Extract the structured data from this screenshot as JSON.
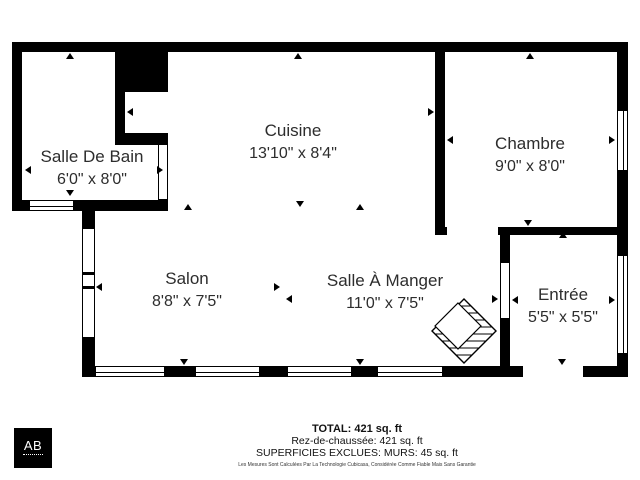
{
  "colors": {
    "wall": "#000000",
    "text": "#2d2d2d",
    "background": "#ffffff"
  },
  "rooms": [
    {
      "name": "Salle De Bain",
      "dims": "6'0\" x 8'0\""
    },
    {
      "name": "Cuisine",
      "dims": "13'10\" x 8'4\""
    },
    {
      "name": "Chambre",
      "dims": "9'0\" x 8'0\""
    },
    {
      "name": "Salon",
      "dims": "8'8\" x 7'5\""
    },
    {
      "name": "Salle À Manger",
      "dims": "11'0\" x 7'5\""
    },
    {
      "name": "Entrée",
      "dims": "5'5\" x 5'5\""
    }
  ],
  "summary": {
    "total": "TOTAL: 421 sq. ft",
    "floor": "Rez-de-chaussée: 421 sq. ft",
    "excluded": "SUPERFICIES EXCLUES: MURS: 45 sq. ft",
    "disclaimer": "Les Mesures Sont Calculées Par La Technologie Cubicasa, Considérée Comme Fiable Mais Sans Garantie"
  },
  "logo": {
    "text": "AB"
  }
}
